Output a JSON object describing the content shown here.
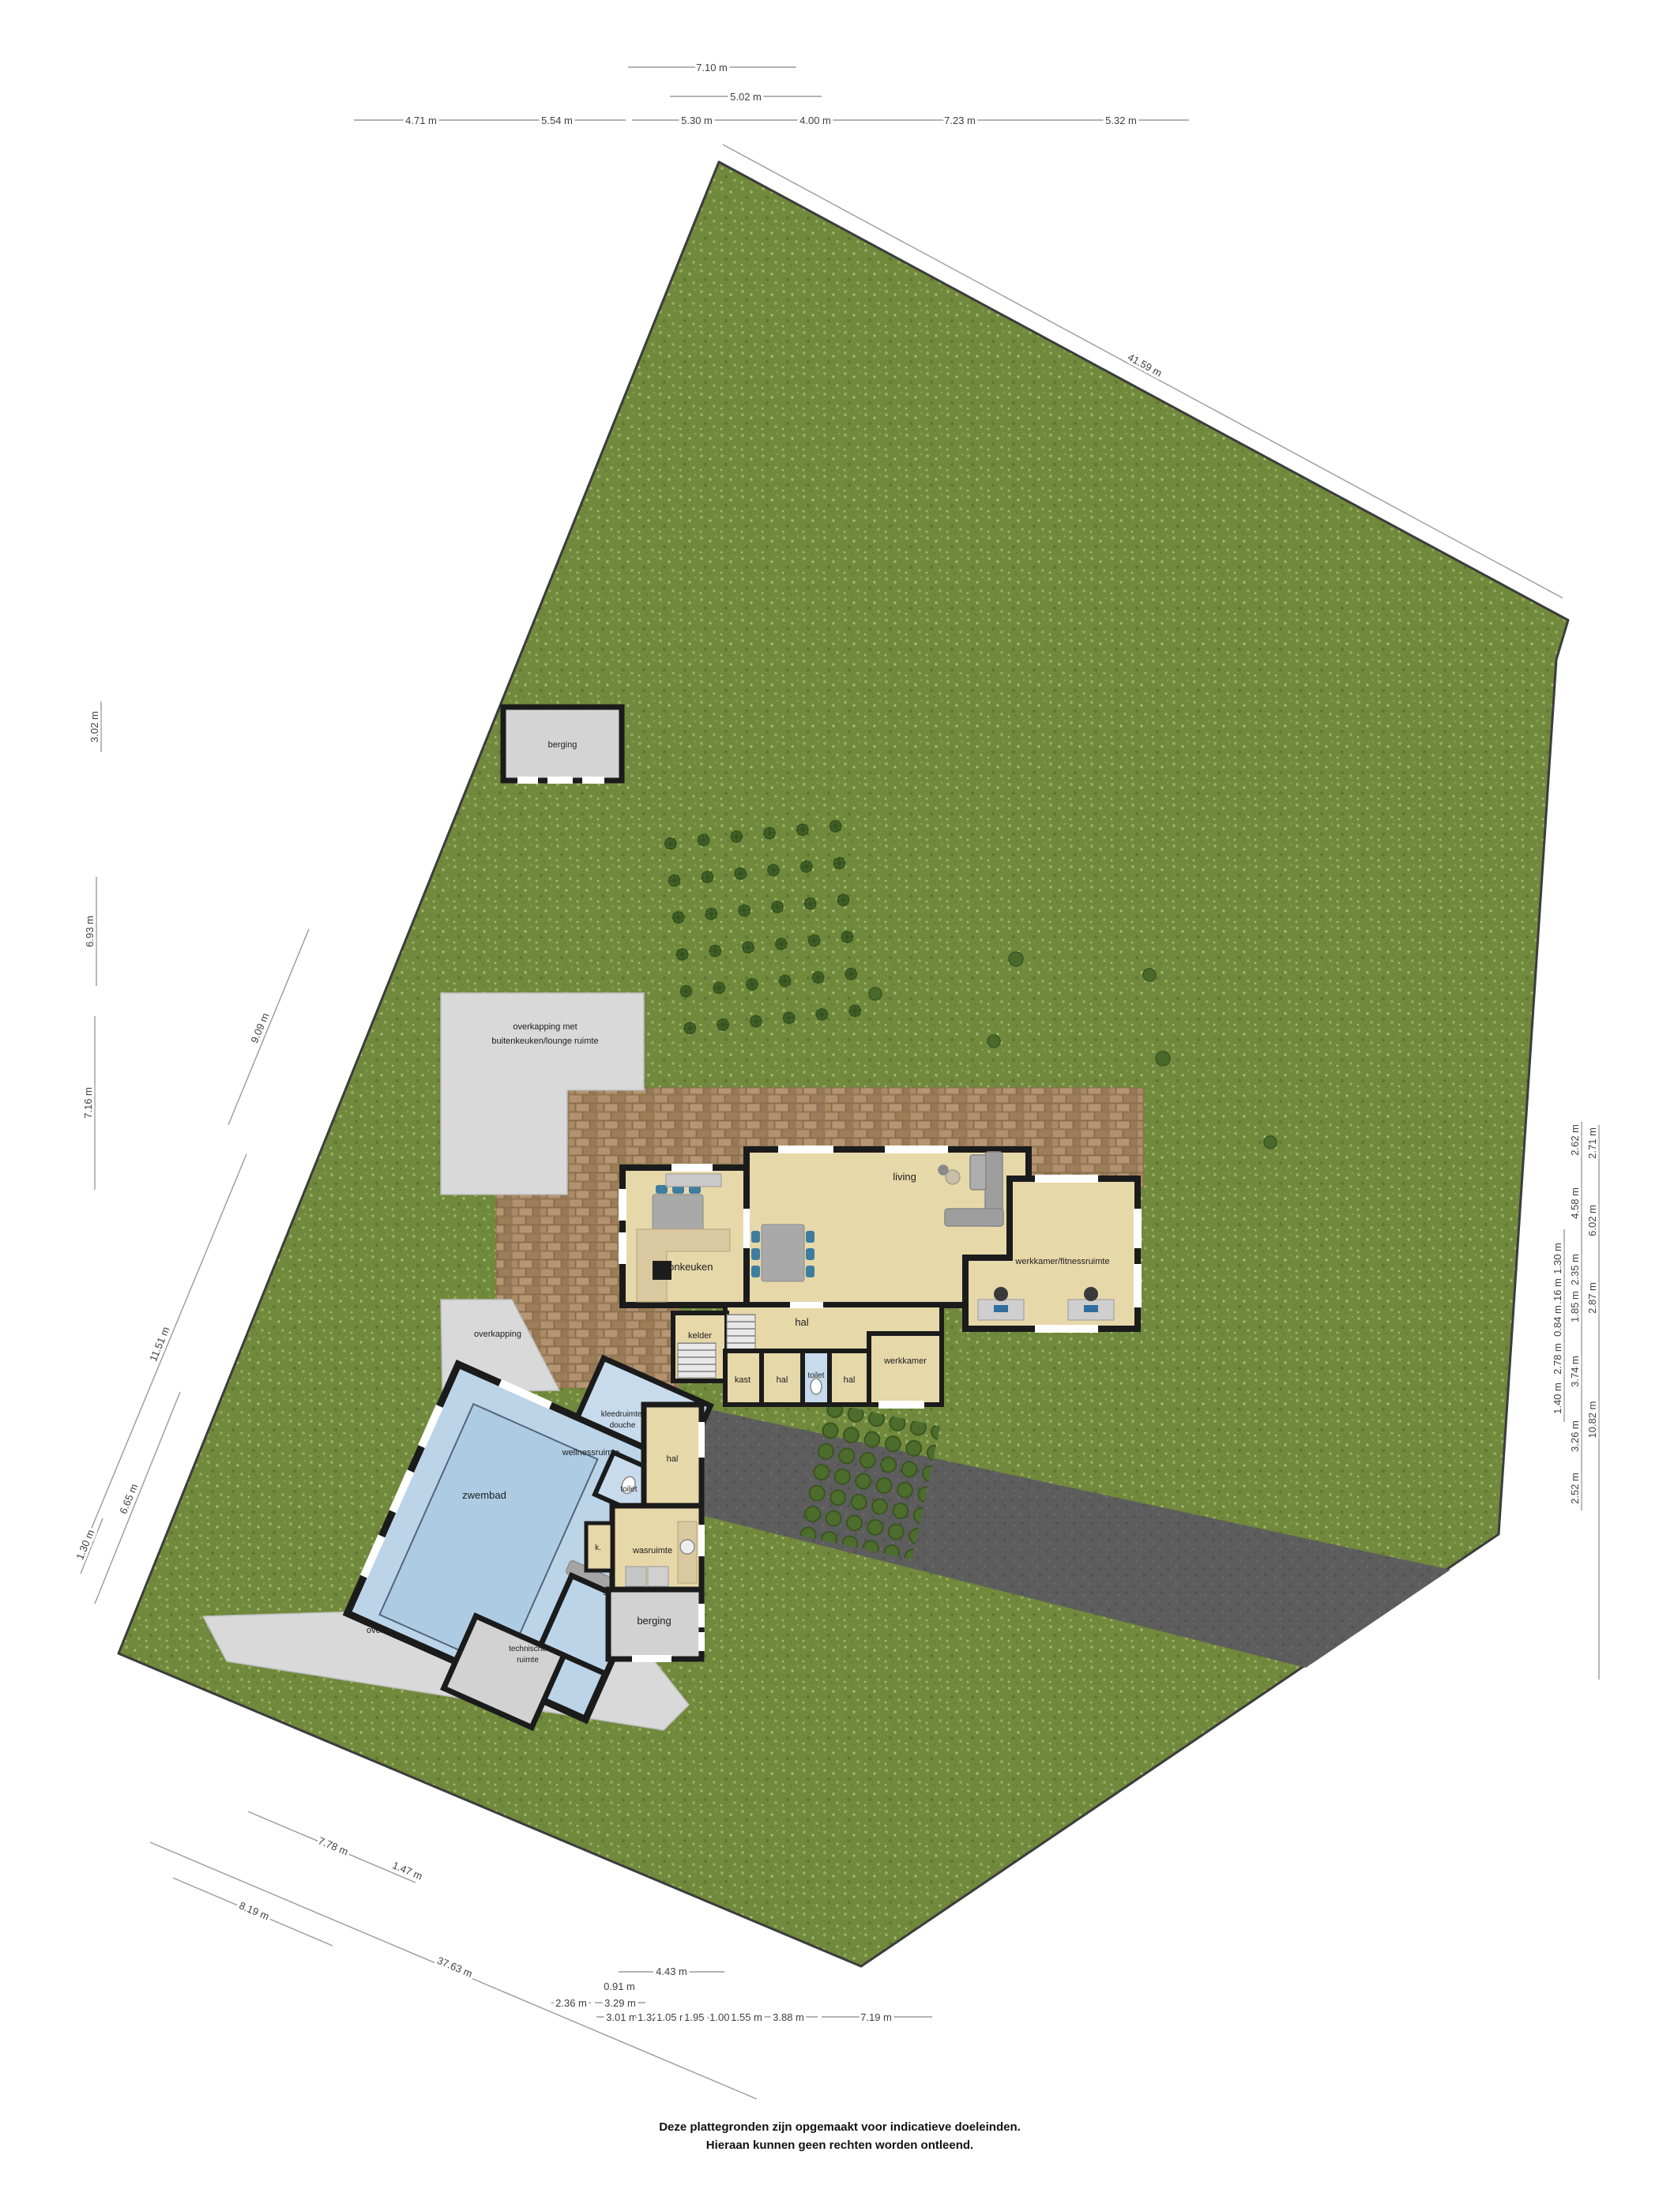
{
  "page": {
    "footer_line1": "Deze plattegronden zijn opgemaakt voor indicatieve doeleinden.",
    "footer_line2": "Hieraan kunnen geen rechten worden ontleend."
  },
  "colors": {
    "grass": "#71893c",
    "wall": "#1b1b1b",
    "room_tan": "#e7d8aa",
    "pool_blue": "#bcd4e8",
    "pool_water": "#aecbe4",
    "canopy_gray": "#d9d9d9",
    "storage_gray": "#d2d2d2",
    "terrace_brick": "#a3865f",
    "driveway": "#5d5d5d",
    "chair_blue": "#3e7d9e"
  },
  "rooms": {
    "shed": "berging",
    "canopy_kitchen_l1": "overkapping met",
    "canopy_kitchen_l2": "buitenkeuken/lounge ruimte",
    "canopy_small": "overkapping",
    "canopy_large": "overkapping",
    "woonkeuken": "woonkeuken",
    "living": "living",
    "hal_main": "hal",
    "kelder": "kelder",
    "kast": "kast",
    "hal_small": "hal",
    "toilet_main": "toilet",
    "hal_2": "hal",
    "werkkamer": "werkkamer",
    "annex": "werkkamer/fitnessruimte",
    "kleedruimte_l1": "kleedruimte/",
    "kleedruimte_l2": "douche",
    "hal_wing": "hal",
    "toilet_wing": "toilet",
    "wasruimte": "wasruimte",
    "kast_small": "k.",
    "berging_house": "berging",
    "zwembad": "zwembad",
    "wellness": "wellnessruimte",
    "sauna": "sauna",
    "tech_l1": "technische",
    "tech_l2": "ruimte"
  },
  "dims": {
    "top": [
      "7.10 m",
      "5.02 m"
    ],
    "top_row": [
      "4.71 m",
      "5.54 m",
      "5.30 m",
      "4.00 m",
      "7.23 m",
      "5.32 m"
    ],
    "top_diag": "41.59 m",
    "left_col": [
      "3.02 m",
      "6.93 m",
      "7.16 m"
    ],
    "left_diag": [
      "9.09 m",
      "11.51 m",
      "6.65 m",
      "1.30 m"
    ],
    "bottom_left_diag": [
      "7.78 m",
      "1.47 m",
      "8.19 m",
      "37.63 m"
    ],
    "bottom_rows": [
      "4.43 m",
      "0.91 m",
      "2.36 m",
      "3.29 m"
    ],
    "bottom_row2": [
      "3.01 m",
      "1.32 m",
      "1.05 m",
      "1.95 m",
      "1.00 m",
      "1.55 m",
      "3.88 m",
      "7.19 m"
    ],
    "right_inner": [
      "1.30 m",
      "2.16 m",
      "0.84 m",
      "2.78 m",
      "1.40 m"
    ],
    "right_mid": [
      "2.62 m",
      "4.58 m",
      "2.35 m",
      "1.85 m",
      "3.74 m",
      "3.26 m",
      "2.52 m"
    ],
    "right_outer": [
      "2.71 m",
      "6.02 m",
      "2.87 m",
      "10.82 m"
    ]
  }
}
